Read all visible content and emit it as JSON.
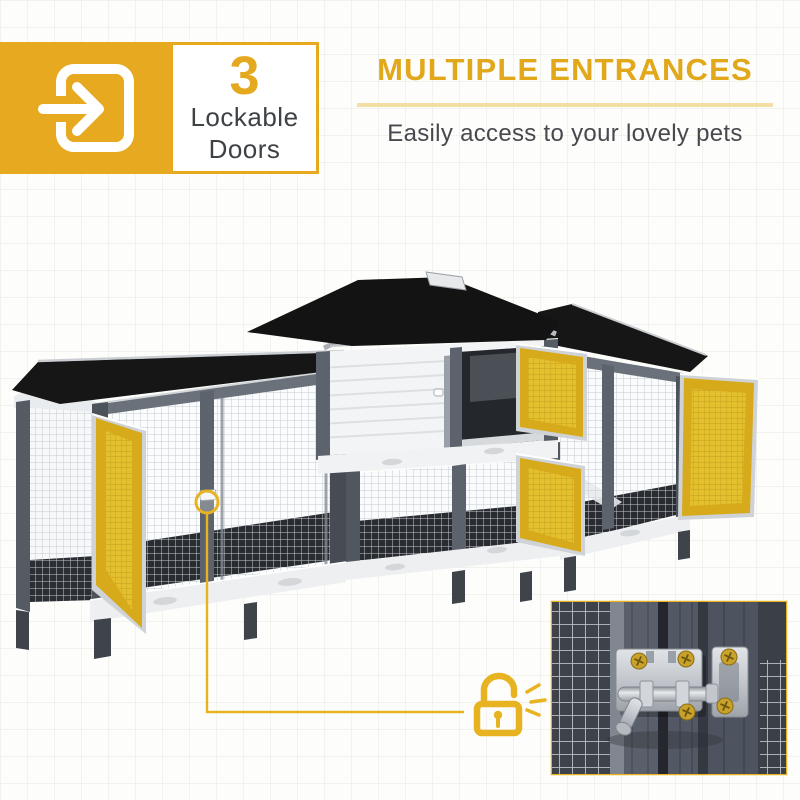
{
  "badge": {
    "count": "3",
    "label_line1": "Lockable",
    "label_line2": "Doors",
    "icon": "door-enter-icon"
  },
  "headline": {
    "title": "MULTIPLE ENTRANCES",
    "subtitle": "Easily access to your lovely pets"
  },
  "product": {
    "brand": "Pawhut",
    "callout_icon": "open-padlock-icon"
  },
  "colors": {
    "accent": "#E6A91F",
    "accent_underline": "#F1DFA4",
    "callout_yellow": "#E7B320",
    "door_highlight": "#D6AA1B",
    "roof_black": "#161616",
    "frame_gray": "#5D636C",
    "panel_white": "#F3F4F6",
    "body_text": "#47494E"
  }
}
